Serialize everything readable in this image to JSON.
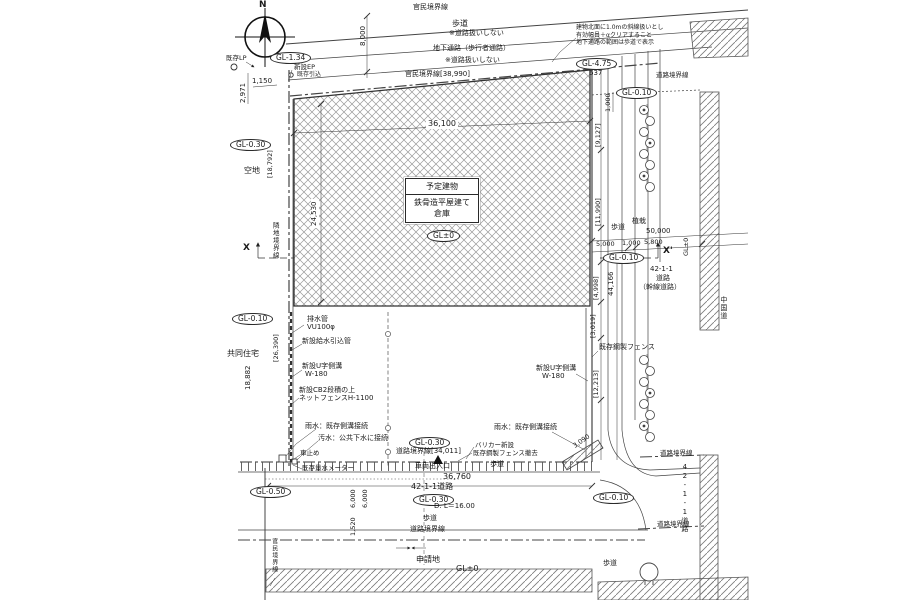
{
  "compass": {
    "n": "N"
  },
  "site": {
    "building": {
      "name": "予定建物",
      "structure": "鉄骨造平屋建て",
      "use": "倉庫"
    },
    "shinseichi": "申請地",
    "kuchi": "空地",
    "kyodo": "共同住宅"
  },
  "levels": {
    "gl134": "GL-1.34",
    "gl475": "GL-4.75",
    "g637": "637",
    "gl030": "GL-0.30",
    "gl010": "GL-0.10",
    "gl050": "GL-0.50",
    "glpm0": "GL±0",
    "dl": "D.  L＝16.00"
  },
  "boundaries": {
    "kanmin": "官民境界線",
    "kanmin_dim": "官民境界線[38,990]",
    "rinchi": "隣地境界線",
    "doro": "道路境界線",
    "doro_dim": "道路境界線[34,011]"
  },
  "roads": {
    "hodo": "歩道",
    "hodo_note": "※道路扱いしない",
    "chika": "地下通路（歩行者通路）",
    "r42": "42-1-1道路",
    "r42_1": "42-1-1",
    "r42_2": "道路",
    "r42_3": "（幹線道路）",
    "shokusai": "植栽",
    "chugoku": "中国道",
    "sharyo": "車両出入口"
  },
  "dims": {
    "d8000": "8,000",
    "d2971": "2,971",
    "d1150": "1,150",
    "d36100": "36,100",
    "d24530": "24,530",
    "d18792": "[18,792]",
    "d26390": "[26,390]",
    "d18882": "18,882",
    "d9127": "[9,127]",
    "d11990": "[11,990]",
    "d4998": "[4,998]",
    "d3019": "[3,019]",
    "d12213": "[12,213]",
    "d44166": "44,166",
    "d50000": "50,000",
    "d5000": "5,000",
    "d1000": "1,000",
    "d5800": "5,800",
    "d36760": "36,760",
    "d6000": "6,000",
    "d1520": "1,520",
    "d3090": "3,090"
  },
  "utils": {
    "haisui": "排水管",
    "vu": "VU100φ",
    "kyusui": "新設給水引込管",
    "uji": "新設U字側溝",
    "w180": "W-180",
    "cb": "新設CB2段積の上",
    "net": "ネットフェンスH-1100",
    "usui": "雨水：既存側溝接続",
    "osui": "汚水：公共下水に接続",
    "kurumadome": "車止め",
    "meter": "既存量水メーター",
    "barika": "バリカー新設",
    "tekkyo": "既存鋼製フェンス撤去",
    "fence": "既存鋼製フェンス",
    "lp": "既存LP",
    "ep": "新設EP",
    "hikikomi": "既存引込"
  },
  "notes": {
    "l1": "建物北面に1.0mの斜線扱いとし",
    "l2": "有効幅員＋αクリアすること",
    "l3": "地下通路の範囲は歩道で表示"
  },
  "section": {
    "x": "X",
    "xp": "X'"
  }
}
